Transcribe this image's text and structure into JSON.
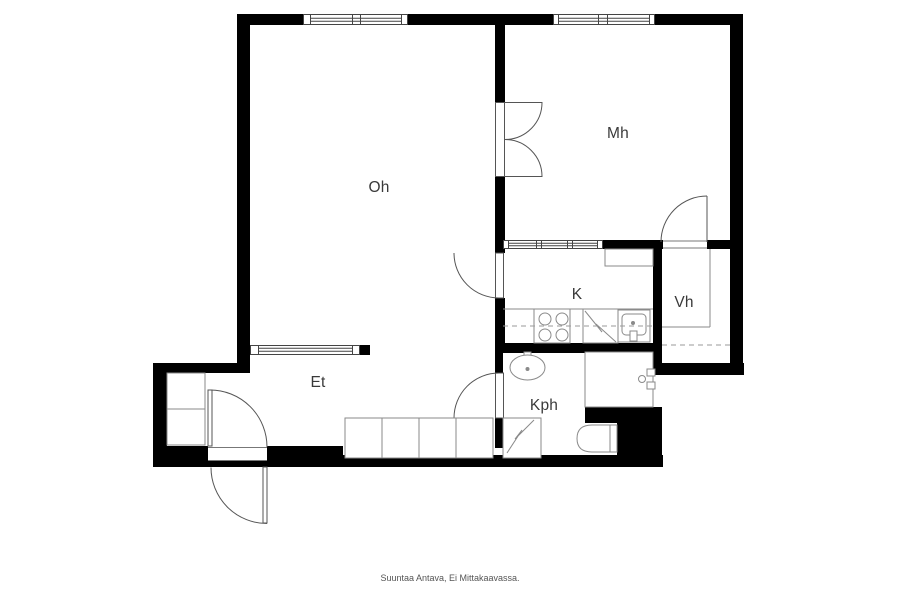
{
  "caption": "Suuntaa Antava, Ei Mittakaavassa.",
  "rooms": {
    "oh": {
      "label": "Oh"
    },
    "mh": {
      "label": "Mh"
    },
    "k": {
      "label": "K"
    },
    "vh": {
      "label": "Vh"
    },
    "et": {
      "label": "Et"
    },
    "kph": {
      "label": "Kph"
    }
  },
  "colors": {
    "wall": "#000000",
    "door_line": "#555555",
    "fixture_line": "#8a8a8a",
    "label_text": "#3a3a3a",
    "caption_text": "#555555",
    "background": "#ffffff"
  }
}
